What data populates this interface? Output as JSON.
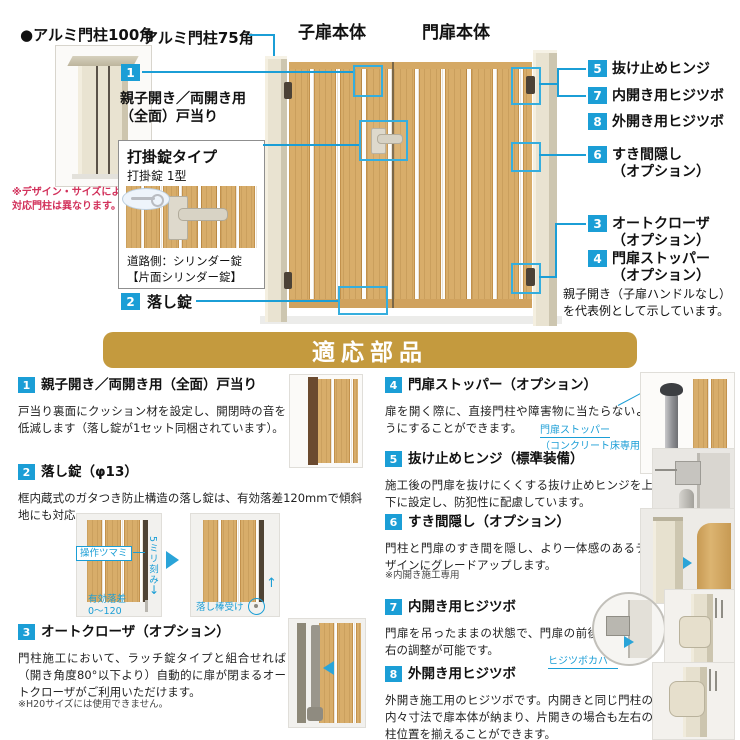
{
  "colors": {
    "accent": "#1b9ed6",
    "banner_bg": "#c49a3e",
    "wood": "#d8ad6a",
    "post": "#e9e3d1",
    "note_red": "#d2315b"
  },
  "top": {
    "post100": {
      "label": "●アルミ門柱100角",
      "note": [
        "※デザイン・サイズによって",
        "対応門柱は異なります。"
      ]
    },
    "post75_label": "アルミ門柱75角",
    "child_door_label": "子扉本体",
    "main_door_label": "門扉本体",
    "callout1": {
      "num": "1",
      "lines": [
        "親子開き／両開き用",
        "（全面）戸当り"
      ]
    },
    "lock_box": {
      "title": "打掛錠タイプ",
      "subtitle": "打掛錠 1型",
      "note": [
        "道路側：シリンダー錠",
        "【片面シリンダー錠】"
      ]
    },
    "callout2": {
      "num": "2",
      "label": "落し錠"
    },
    "diagram_labels": {
      "l5": {
        "num": "5",
        "label": "抜け止めヒンジ"
      },
      "l7": {
        "num": "7",
        "label": "内開き用ヒジツボ"
      },
      "l8": {
        "num": "8",
        "label": "外開き用ヒジツボ"
      },
      "l6": {
        "num": "6",
        "label": "すき間隠し",
        "sub": "（オプション）"
      },
      "l3": {
        "num": "3",
        "label": "オートクローザ",
        "sub": "（オプション）"
      },
      "l4": {
        "num": "4",
        "label": "門扉ストッパー",
        "sub": "（オプション）"
      }
    },
    "rep_note": [
      "親子開き（子扉ハンドルなし）",
      "を代表例として示しています。"
    ]
  },
  "banner": {
    "title": "適応部品"
  },
  "items": [
    {
      "num": "1",
      "title": "親子開き／両開き用（全面）戸当り",
      "body": "戸当り裏面にクッション材を設定し、開閉時の音を低減します（落し錠が1セット同梱されています）。"
    },
    {
      "num": "2",
      "title": "落し錠（φ13）",
      "body": "框内蔵式のガタつき防止構造の落し錠は、有効落差120mmで傾斜地にも対応。",
      "fig": {
        "knob": "操作ツマミ",
        "pitch": "5ミリ刻み",
        "drop": [
          "有効落差",
          "0〜120"
        ],
        "receiver": "落し棒受け"
      }
    },
    {
      "num": "3",
      "title": "オートクローザ（オプション）",
      "body": "門柱施工において、ラッチ錠タイプと組合せれば（開き角度80°以下より）自動的に扉が閉まるオートクローザがご利用いただけます。",
      "note": "※H20サイズには使用できません。"
    },
    {
      "num": "4",
      "title": "門扉ストッパー（オプション）",
      "body": "扉を開く際に、直接門柱や障害物に当たらないようにすることができます。",
      "caption": [
        "門扉ストッパー",
        "（コンクリート床専用）"
      ]
    },
    {
      "num": "5",
      "title": "抜け止めヒンジ（標準装備）",
      "body": "施工後の門扉を抜けにくくする抜け止めヒンジを上下に設定し、防犯性に配慮しています。"
    },
    {
      "num": "6",
      "title": "すき間隠し（オプション）",
      "body": "門柱と門扉のすき間を隠し、より一体感のあるデザインにグレードアップします。",
      "note": "※内開き施工専用"
    },
    {
      "num": "7",
      "title": "内開き用ヒジツボ",
      "body": "門扉を吊ったままの状態で、門扉の前後左右の調整が可能です。",
      "caption": "ヒジツボカバー"
    },
    {
      "num": "8",
      "title": "外開き用ヒジツボ",
      "body": "外開き施工用のヒジツボです。内開きと同じ門柱の内々寸法で扉本体が納まり、片開きの場合も左右の柱位置を揃えることができます。"
    }
  ]
}
